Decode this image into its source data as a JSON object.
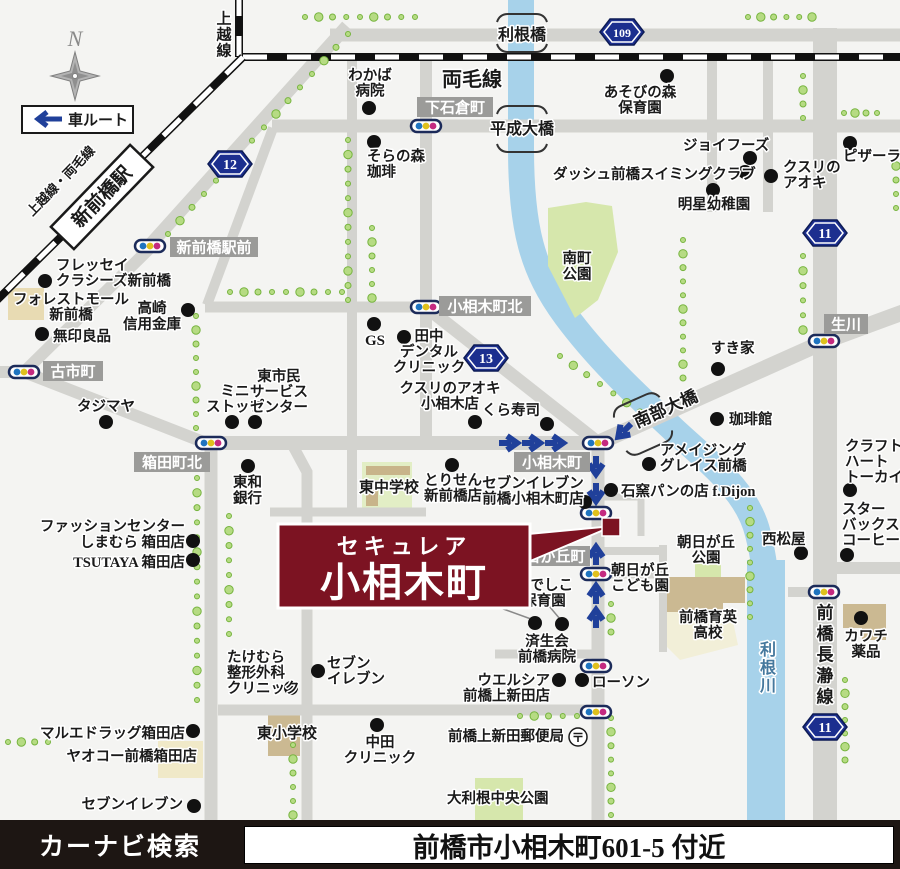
{
  "bottom_bar": {
    "left": "カーナビ検索",
    "address": "前橋市小相木町601-5 付近"
  },
  "legend": {
    "north": "N",
    "car_route": "車ルート"
  },
  "callout": {
    "line1": "セキュレア",
    "line2": "小相木町"
  },
  "colors": {
    "accent_red": "#7c1322",
    "road": "#d3d3cf",
    "river": "#a7d2ea",
    "sign_blue": "#1c2f8f",
    "arrow_blue": "#20409a",
    "label_box_gray": "#9b9b99",
    "park_green": "#d6e7ac",
    "tree_green": "#b6db83"
  },
  "map": {
    "rail_labels": {
      "joetsu": {
        "text": "上越線",
        "x": 224,
        "y": 14,
        "fs": 15,
        "lh": 16
      },
      "ryomo": {
        "text": "両毛線",
        "x": 472,
        "y": 86,
        "fs": 20
      },
      "joetsu_ryomo": {
        "text": "上越線・両毛線",
        "x": 64,
        "y": 184,
        "rot": -46,
        "fs": 13
      },
      "station": {
        "text": "新前橋駅",
        "x": 102,
        "y": 197,
        "rot": -46,
        "fs": 19,
        "w": 114,
        "h": 32
      }
    },
    "water_vlabels": [
      {
        "text": "利根川",
        "x": 768,
        "y": 644,
        "fs": 16,
        "lh": 18,
        "fill": "#45789d"
      }
    ],
    "road_vlabels": [
      {
        "text": "前橋長瀞線",
        "x": 825,
        "y": 606,
        "fs": 17,
        "lh": 21
      }
    ],
    "bridges": [
      {
        "text": "利根橋",
        "x": 522,
        "y": 40,
        "fs": 16,
        "rot": 0,
        "marks": [
          [
            522,
            15,
            0,
            0
          ],
          [
            522,
            51,
            0,
            1
          ]
        ]
      },
      {
        "text": "平成大橋",
        "x": 522,
        "y": 134,
        "fs": 16,
        "rot": 0,
        "marks": [
          [
            522,
            107,
            0,
            0
          ],
          [
            522,
            151,
            0,
            1
          ]
        ]
      },
      {
        "text": "南部大橋",
        "x": 668,
        "y": 414,
        "fs": 17,
        "rot": -24,
        "marks": [
          [
            634,
            401,
            -24,
            0
          ],
          [
            652,
            447,
            -24,
            1
          ]
        ]
      }
    ],
    "intersections": [
      {
        "text": "新前橋駅前",
        "x": 214,
        "y": 247,
        "w": 88
      },
      {
        "text": "下石倉町",
        "x": 455,
        "y": 107,
        "w": 76
      },
      {
        "text": "小相木町北",
        "x": 485,
        "y": 306,
        "w": 92
      },
      {
        "text": "古市町",
        "x": 73,
        "y": 371,
        "w": 60
      },
      {
        "text": "箱田町北",
        "x": 172,
        "y": 462,
        "w": 76
      },
      {
        "text": "小相木町",
        "x": 552,
        "y": 462,
        "w": 76
      },
      {
        "text": "朝日が丘町",
        "x": 548,
        "y": 556,
        "w": 84
      },
      {
        "text": "生川",
        "x": 846,
        "y": 324,
        "w": 44
      }
    ],
    "route_signs": [
      {
        "num": "12",
        "x": 230,
        "y": 164
      },
      {
        "num": "109",
        "x": 622,
        "y": 32
      },
      {
        "num": "13",
        "x": 486,
        "y": 358
      },
      {
        "num": "11",
        "x": 825,
        "y": 233
      },
      {
        "num": "11",
        "x": 825,
        "y": 727
      }
    ],
    "traffic_lights": [
      [
        150,
        246
      ],
      [
        426,
        126
      ],
      [
        426,
        307
      ],
      [
        24,
        372
      ],
      [
        211,
        443
      ],
      [
        598,
        443
      ],
      [
        596,
        513
      ],
      [
        596,
        574
      ],
      [
        596,
        666
      ],
      [
        596,
        712
      ],
      [
        824,
        341
      ],
      [
        824,
        592
      ]
    ],
    "route_arrows": [
      [
        509,
        443,
        0
      ],
      [
        532,
        443,
        0
      ],
      [
        555,
        443,
        0
      ],
      [
        624,
        431,
        135
      ],
      [
        596,
        466,
        90
      ],
      [
        596,
        493,
        90
      ],
      [
        596,
        555,
        -90
      ],
      [
        596,
        594,
        -90
      ],
      [
        596,
        618,
        -90
      ]
    ],
    "post_office": {
      "x": 578,
      "y": 737
    },
    "pois": [
      {
        "n": "wakaba-hospital",
        "lines": [
          "わかば",
          "病院"
        ],
        "x": 370,
        "y": 80,
        "a": "m",
        "dot": [
          369,
          108
        ]
      },
      {
        "n": "soranomori-coffee",
        "lines": [
          "そらの森",
          "珈琲"
        ],
        "x": 367,
        "y": 161,
        "a": "s",
        "dot": [
          374,
          142
        ]
      },
      {
        "n": "asobinomori-nursery",
        "lines": [
          "あそびの森",
          "保育園"
        ],
        "x": 640,
        "y": 97,
        "a": "m",
        "dot": [
          667,
          76
        ]
      },
      {
        "n": "joyfoods",
        "lines": [
          "ジョイフーズ"
        ],
        "x": 683,
        "y": 150,
        "a": "s",
        "dot": [
          750,
          158
        ]
      },
      {
        "n": "dash-swimming-club",
        "lines": [
          "ダッシュ前橋スイミングクラブ"
        ],
        "x": 553,
        "y": 179,
        "a": "s",
        "dot": [
          745,
          172
        ]
      },
      {
        "n": "meisei-kindergarten",
        "lines": [
          "明星幼稚園"
        ],
        "x": 714,
        "y": 209,
        "a": "m",
        "dot": [
          713,
          190
        ]
      },
      {
        "n": "kusuri-no-aoki",
        "lines": [
          "クスリの",
          "アオキ"
        ],
        "x": 783,
        "y": 172,
        "a": "s",
        "dot": [
          771,
          176
        ]
      },
      {
        "n": "pizza-la",
        "lines": [
          "ピザーラ"
        ],
        "x": 843,
        "y": 161,
        "a": "s",
        "dot": [
          850,
          143
        ]
      },
      {
        "n": "fressay-classes-shinmaebashi",
        "lines": [
          "フレッセイ",
          "クラシーズ新前橋"
        ],
        "x": 56,
        "y": 270,
        "a": "s",
        "dot": [
          45,
          281
        ]
      },
      {
        "n": "forest-mall-shinmaebashi",
        "lines": [
          "フォレストモール",
          "新前橋"
        ],
        "x": 71,
        "y": 304,
        "a": "m"
      },
      {
        "n": "muji",
        "lines": [
          "無印良品"
        ],
        "x": 53,
        "y": 341,
        "a": "s",
        "dot": [
          42,
          334
        ]
      },
      {
        "n": "takasaki-shinkin-bank",
        "lines": [
          "高崎",
          "信用金庫"
        ],
        "x": 152,
        "y": 313,
        "a": "m",
        "lh": 16,
        "dot": [
          188,
          310
        ]
      },
      {
        "n": "tajimaya",
        "lines": [
          "タジマヤ"
        ],
        "x": 106,
        "y": 411,
        "a": "m",
        "dot": [
          106,
          422
        ]
      },
      {
        "n": "ministop",
        "lines": [
          "ミニ",
          "ストップ"
        ],
        "x": 235,
        "y": 396,
        "a": "m",
        "dot": [
          232,
          422
        ]
      },
      {
        "n": "higashi-civic-service-center",
        "lines": [
          "東市民",
          "サービス",
          "センター"
        ],
        "x": 279,
        "y": 381,
        "a": "m",
        "dot": [
          255,
          422
        ]
      },
      {
        "n": "towa-bank",
        "lines": [
          "東和",
          "銀行"
        ],
        "x": 233,
        "y": 487,
        "a": "s",
        "lh": 16,
        "dot": [
          248,
          466
        ]
      },
      {
        "n": "shimamura-hakoda",
        "lines": [
          "ファッションセンター",
          "しまむら 箱田店"
        ],
        "x": 185,
        "y": 531,
        "a": "e",
        "lh": 16,
        "dot": [
          193,
          541
        ]
      },
      {
        "n": "tsutaya-hakoda",
        "lines": [
          "TSUTAYA 箱田店"
        ],
        "x": 185,
        "y": 567,
        "a": "e",
        "dot": [
          193,
          560
        ]
      },
      {
        "n": "takemura-orthopedics",
        "lines": [
          "たけむら",
          "整形外科",
          "クリニック"
        ],
        "x": 227,
        "y": 662,
        "a": "s",
        "dot": [
          291,
          688
        ]
      },
      {
        "n": "seven-eleven-hakoda",
        "lines": [
          "セブン",
          "イレブン"
        ],
        "x": 327,
        "y": 668,
        "a": "s",
        "dot": [
          318,
          671
        ]
      },
      {
        "n": "marue-drug-hakoda",
        "lines": [
          "マルエドラッグ箱田店"
        ],
        "x": 185,
        "y": 738,
        "a": "e",
        "dot": [
          193,
          731
        ]
      },
      {
        "n": "yaoko-maebashi-hakoda",
        "lines": [
          "ヤオコー前橋箱田店"
        ],
        "x": 197,
        "y": 761,
        "a": "e"
      },
      {
        "n": "seven-eleven-southwest",
        "lines": [
          "セブンイレブン"
        ],
        "x": 183,
        "y": 809,
        "a": "e",
        "dot": [
          194,
          806
        ]
      },
      {
        "n": "higashi-elementary",
        "lines": [
          "東小学校"
        ],
        "x": 287,
        "y": 738,
        "a": "m",
        "fs": 15
      },
      {
        "n": "nakada-clinic",
        "lines": [
          "中田",
          "クリニック"
        ],
        "x": 380,
        "y": 747,
        "a": "m",
        "dot": [
          377,
          725
        ]
      },
      {
        "n": "kamishinden-post-office",
        "lines": [
          "前橋上新田郵便局"
        ],
        "x": 448,
        "y": 741,
        "a": "s"
      },
      {
        "n": "otone-central-park",
        "lines": [
          "大利根中央公園"
        ],
        "x": 447,
        "y": 803,
        "a": "s"
      },
      {
        "n": "welcia-kamishinden",
        "lines": [
          "ウエルシア",
          "前橋上新田店"
        ],
        "x": 550,
        "y": 685,
        "a": "e",
        "dot": [
          559,
          680
        ]
      },
      {
        "n": "lawson",
        "lines": [
          "ローソン"
        ],
        "x": 592,
        "y": 687,
        "a": "s",
        "dot": [
          582,
          680
        ]
      },
      {
        "n": "saiseikai-maebashi-hospital",
        "lines": [
          "済生会",
          "前橋病院"
        ],
        "x": 547,
        "y": 646,
        "a": "m"
      },
      {
        "n": "tokiwa-nursery",
        "lines": [
          "トキワ",
          "保育園"
        ],
        "x": 487,
        "y": 590,
        "a": "m",
        "dot": [
          535,
          623
        ],
        "leader": [
          495,
          606,
          531,
          619
        ]
      },
      {
        "n": "nadeshiko-nursery",
        "lines": [
          "なでしこ",
          "保育園"
        ],
        "x": 544,
        "y": 590,
        "a": "m",
        "dot": [
          562,
          624
        ],
        "leader": [
          549,
          606,
          560,
          619
        ]
      },
      {
        "n": "torisen-shinmaebashi",
        "lines": [
          "とりせん",
          "新前橋店"
        ],
        "x": 453,
        "y": 485,
        "a": "m",
        "dot": [
          452,
          465
        ]
      },
      {
        "n": "seven-eleven-koaigicho",
        "lines": [
          "セブンイレブン",
          "前橋小相木町店"
        ],
        "x": 533,
        "y": 488,
        "a": "m",
        "dot": [
          585,
          502
        ]
      },
      {
        "n": "higashi-junior-high",
        "lines": [
          "東中学校"
        ],
        "x": 389,
        "y": 492,
        "a": "m",
        "fs": 15
      },
      {
        "n": "ishigama-pan-fdijon",
        "lines": [
          "石窯パンの店 f.Dijon"
        ],
        "x": 621,
        "y": 496,
        "a": "s",
        "dot": [
          611,
          490
        ]
      },
      {
        "n": "amazing-grace-maebashi",
        "lines": [
          "アメイジング",
          "グレイス前橋"
        ],
        "x": 660,
        "y": 455,
        "a": "s",
        "dot": [
          649,
          464
        ]
      },
      {
        "n": "coffee-kan",
        "lines": [
          "珈琲館"
        ],
        "x": 729,
        "y": 424,
        "a": "s",
        "dot": [
          717,
          419
        ]
      },
      {
        "n": "sukiya",
        "lines": [
          "すき家"
        ],
        "x": 711,
        "y": 353,
        "a": "s",
        "dot": [
          718,
          369
        ]
      },
      {
        "n": "craft-heart-tokai",
        "lines": [
          "クラフト",
          "ハート",
          "トーカイ"
        ],
        "x": 845,
        "y": 451,
        "a": "s",
        "dot": [
          850,
          490
        ]
      },
      {
        "n": "starbucks-coffee",
        "lines": [
          "スター",
          "バックス",
          "コーヒー"
        ],
        "x": 842,
        "y": 514,
        "a": "s",
        "dot": [
          847,
          555
        ]
      },
      {
        "n": "nishimatsuya",
        "lines": [
          "西松屋"
        ],
        "x": 762,
        "y": 544,
        "a": "s",
        "dot": [
          801,
          553
        ]
      },
      {
        "n": "kawachi-drug",
        "lines": [
          "カワチ",
          "薬品"
        ],
        "x": 866,
        "y": 641,
        "a": "m",
        "dot": [
          861,
          618
        ]
      },
      {
        "n": "asahigaoka-park",
        "lines": [
          "朝日が丘",
          "公園"
        ],
        "x": 706,
        "y": 547,
        "a": "m"
      },
      {
        "n": "asahigaoka-kodomoen",
        "lines": [
          "朝日が丘",
          "こども園"
        ],
        "x": 640,
        "y": 575,
        "a": "m"
      },
      {
        "n": "ikuei-high-school",
        "lines": [
          "前橋育英",
          "高校"
        ],
        "x": 708,
        "y": 622,
        "a": "m"
      },
      {
        "n": "minamimachi-park",
        "lines": [
          "南町",
          "公園"
        ],
        "x": 577,
        "y": 263,
        "a": "m",
        "lh": 16
      },
      {
        "n": "gs-station",
        "lines": [
          "GS"
        ],
        "x": 375,
        "y": 345,
        "a": "m",
        "fs": 15,
        "dot": [
          374,
          324
        ]
      },
      {
        "n": "tanaka-dental-clinic",
        "lines": [
          "田中",
          "デンタル",
          "クリニック"
        ],
        "x": 429,
        "y": 341,
        "a": "m",
        "dot": [
          404,
          337
        ]
      },
      {
        "n": "kura-sushi",
        "lines": [
          "くら寿司"
        ],
        "x": 482,
        "y": 415,
        "a": "s",
        "dot": [
          547,
          424
        ]
      },
      {
        "n": "kusuri-no-aoki-koaigi",
        "lines": [
          "クスリのアオキ",
          "小相木店"
        ],
        "x": 450,
        "y": 393,
        "a": "m",
        "dot": [
          475,
          422
        ]
      }
    ]
  }
}
